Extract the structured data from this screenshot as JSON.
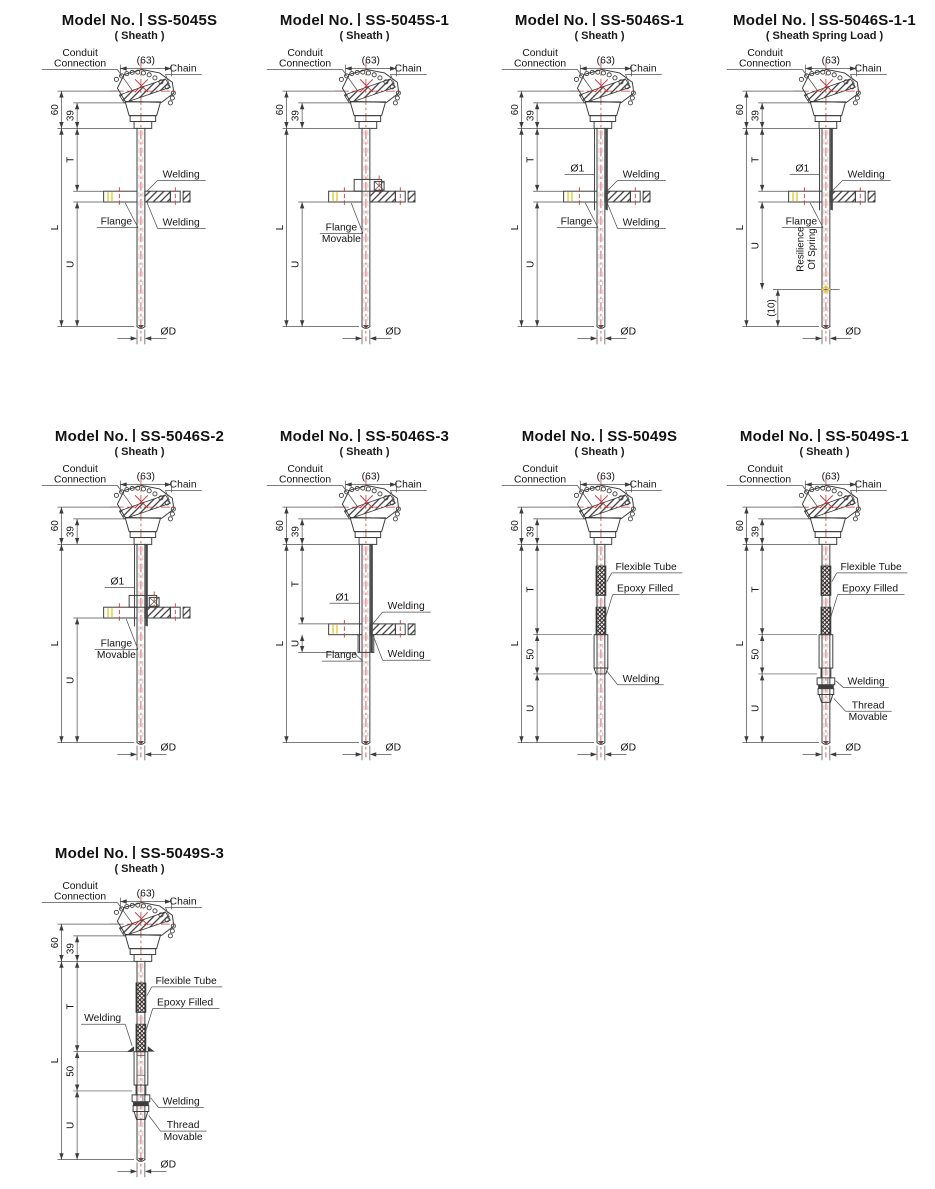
{
  "page": {
    "background": "#ffffff"
  },
  "colors": {
    "line": "#3c3c3c",
    "centerline_red": "#c4383c",
    "bolt_mark_yellow": "#e7d44e",
    "text": "#141414"
  },
  "shared_labels": {
    "title_prefix": "Model No.",
    "conduit_line1": "Conduit",
    "conduit_line2": "Connection",
    "chain": "Chain",
    "dim_63": "(63)",
    "dim_60": "60",
    "dim_39": "39",
    "dim_T": "T",
    "dim_L": "L",
    "dim_U": "U",
    "dim_50": "50",
    "dim_10": "(10)",
    "dim_OD": "ØD",
    "dim_O1": "Ø1",
    "welding": "Welding",
    "flange": "Flange",
    "movable": "Movable",
    "flexible_tube": "Flexible Tube",
    "epoxy_filled": "Epoxy Filled",
    "thread_line1": "Thread",
    "thread_line2": "Movable",
    "resilience_line1": "Resilience",
    "resilience_line2": "Of Spring"
  },
  "models": [
    {
      "code": "SS-5045S",
      "subtitle": "( Sheath )",
      "features": {
        "flange": "fixed",
        "phi1": false,
        "welding_top": true,
        "welding_bottom": true,
        "welding_left": false,
        "flexible_tube": false,
        "thread_movable": false,
        "spring": false,
        "dims": [
          "(63)",
          "60",
          "39",
          "T",
          "L",
          "U",
          "ØD"
        ]
      }
    },
    {
      "code": "SS-5045S-1",
      "subtitle": "( Sheath )",
      "features": {
        "flange": "movable",
        "phi1": false,
        "welding_top": false,
        "welding_bottom": false,
        "welding_left": false,
        "flexible_tube": false,
        "thread_movable": false,
        "spring": false,
        "dims": [
          "(63)",
          "60",
          "39",
          "L",
          "U",
          "ØD"
        ]
      }
    },
    {
      "code": "SS-5046S-1",
      "subtitle": "( Sheath )",
      "features": {
        "flange": "fixed",
        "phi1": true,
        "welding_top": true,
        "welding_bottom": true,
        "welding_left": false,
        "flexible_tube": false,
        "thread_movable": false,
        "spring": false,
        "dims": [
          "(63)",
          "60",
          "39",
          "T",
          "L",
          "U",
          "Ø1",
          "ØD"
        ]
      }
    },
    {
      "code": "SS-5046S-1-1",
      "subtitle": "( Sheath Spring Load )",
      "features": {
        "flange": "fixed",
        "phi1": true,
        "welding_top": true,
        "welding_bottom": false,
        "welding_left": false,
        "flexible_tube": false,
        "thread_movable": false,
        "spring": true,
        "dims": [
          "(63)",
          "60",
          "39",
          "T",
          "L",
          "U",
          "(10)",
          "Ø1",
          "ØD"
        ]
      }
    },
    {
      "code": "SS-5046S-2",
      "subtitle": "( Sheath )",
      "features": {
        "flange": "movable",
        "phi1": true,
        "welding_top": false,
        "welding_bottom": false,
        "welding_left": false,
        "flexible_tube": false,
        "thread_movable": false,
        "spring": false,
        "dims": [
          "(63)",
          "60",
          "39",
          "L",
          "U",
          "Ø1",
          "ØD"
        ]
      }
    },
    {
      "code": "SS-5046S-3",
      "subtitle": "( Sheath )",
      "features": {
        "flange": "fixed-low",
        "phi1": true,
        "welding_top": true,
        "welding_bottom": true,
        "welding_left": false,
        "flexible_tube": false,
        "thread_movable": false,
        "spring": false,
        "dims": [
          "(63)",
          "60",
          "39",
          "T",
          "U",
          "L",
          "Ø1",
          "ØD"
        ]
      }
    },
    {
      "code": "SS-5049S",
      "subtitle": "( Sheath )",
      "features": {
        "flange": null,
        "phi1": false,
        "welding_top": false,
        "welding_bottom": false,
        "welding_left": false,
        "flexible_tube": true,
        "thread_movable": false,
        "spring": false,
        "dims": [
          "(63)",
          "60",
          "39",
          "T",
          "50",
          "L",
          "U",
          "ØD"
        ]
      }
    },
    {
      "code": "SS-5049S-1",
      "subtitle": "( Sheath )",
      "features": {
        "flange": null,
        "phi1": false,
        "welding_top": false,
        "welding_bottom": false,
        "welding_left": false,
        "flexible_tube": true,
        "thread_movable": true,
        "spring": false,
        "dims": [
          "(63)",
          "60",
          "39",
          "T",
          "50",
          "L",
          "U",
          "ØD"
        ]
      }
    },
    {
      "code": "SS-5049S-3",
      "subtitle": "( Sheath )",
      "features": {
        "flange": null,
        "phi1": false,
        "welding_top": false,
        "welding_bottom": false,
        "welding_left": true,
        "flexible_tube": true,
        "thread_movable": true,
        "spring": false,
        "dims": [
          "(63)",
          "60",
          "39",
          "T",
          "50",
          "L",
          "U",
          "ØD"
        ]
      }
    }
  ]
}
